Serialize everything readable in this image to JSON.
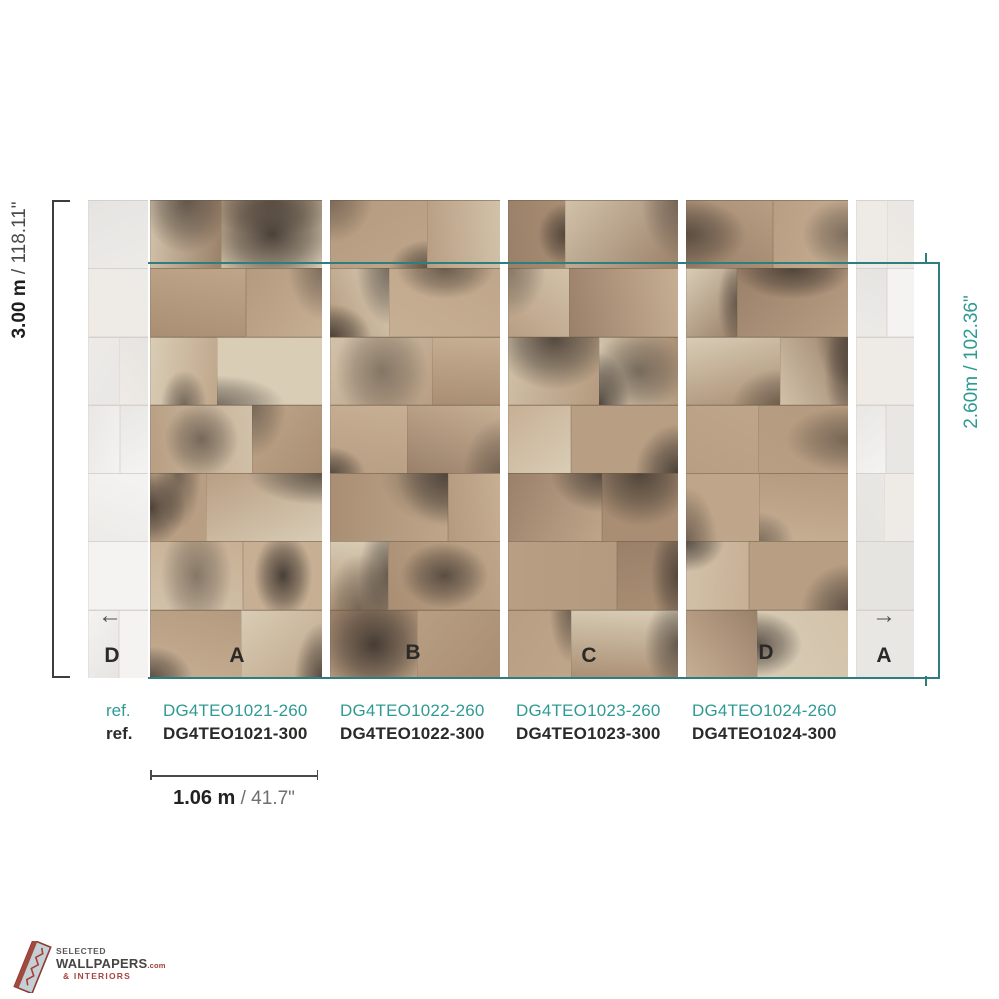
{
  "dim_left": {
    "value": "3.00 m",
    "imperial": " / 118.11\""
  },
  "dim_right": {
    "value": "2.60m",
    "imperial": " / 102.36\""
  },
  "dim_width": {
    "value": "1.06 m",
    "imperial": " / 41.7\""
  },
  "arrows": {
    "left": "←",
    "right": "→"
  },
  "panel_labels": {
    "strip_left": "D",
    "a": "A",
    "b": "B",
    "c": "C",
    "d": "D",
    "strip_right": "A"
  },
  "refs": {
    "teal": {
      "label": "ref.",
      "codes": [
        "DG4TEO1021-260",
        "DG4TEO1022-260",
        "DG4TEO1023-260",
        "DG4TEO1024-260"
      ]
    },
    "black": {
      "label": "ref.",
      "codes": [
        "DG4TEO1021-300",
        "DG4TEO1022-300",
        "DG4TEO1023-300",
        "DG4TEO1024-300"
      ]
    }
  },
  "logo": {
    "top": "SELECTED",
    "main": "WALLPAPERS",
    "suffix": ".com",
    "bottom": "& INTERIORS"
  },
  "colors": {
    "teal_text": "#2f9a94",
    "teal_line": "#2e7d7f",
    "bracket": "#3d3d3d",
    "black_text": "#2b2a28",
    "logo_red": "#9c4038"
  },
  "mural": {
    "seed": 12,
    "rows": 7,
    "tan_palette": [
      "#b89e83",
      "#c7af94",
      "#a98e73",
      "#d2c2aa",
      "#bfa68a",
      "#9a8069",
      "#d9cdb6",
      "#b49a7e"
    ],
    "grey_palette": [
      "#edebe8",
      "#f4f3f1",
      "#e6e4e1",
      "#efeae4",
      "#e9e7e4"
    ],
    "smudge_rgb": "56,48,42"
  }
}
